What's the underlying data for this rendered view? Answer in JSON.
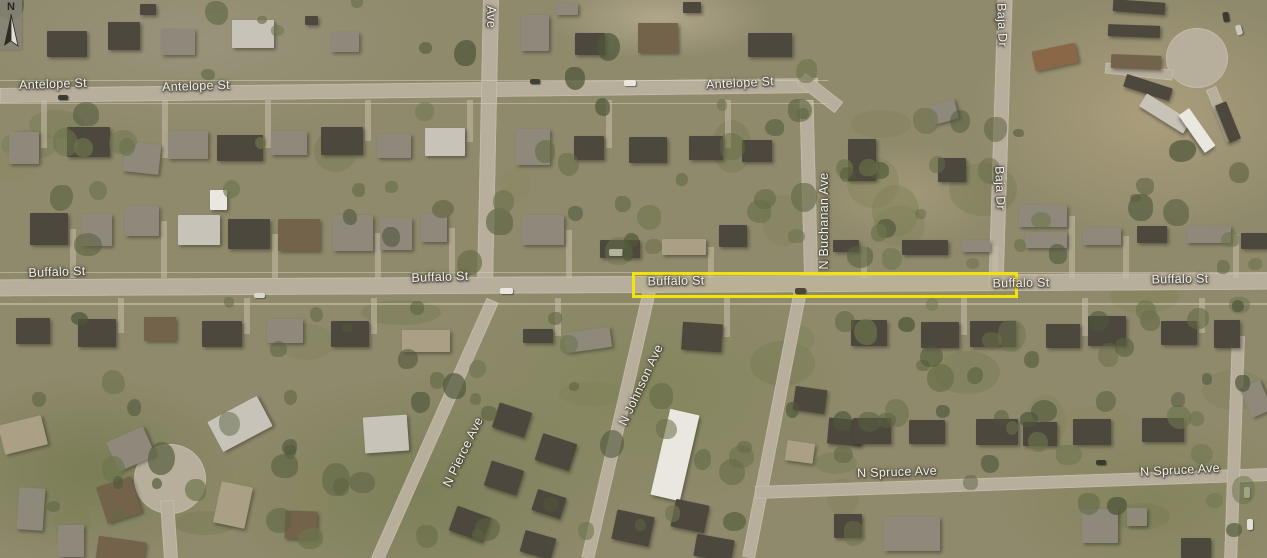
{
  "map": {
    "description": "Aerial imagery of residential neighborhood with highlighted segment of Buffalo St",
    "colors": {
      "highlight": "#f2e40a",
      "label_text": "#f3f1ea",
      "label_shadow": "#45423 8",
      "road": "#b7ae9c",
      "ground": "#8f8a6c"
    },
    "compass": {
      "label": "N"
    },
    "highlight": {
      "x": 633,
      "y": 273,
      "width": 382,
      "height": 22,
      "stroke": 3
    },
    "labels": [
      {
        "text": "Antelope St",
        "x": 53,
        "y": 84,
        "rot": -2
      },
      {
        "text": "Antelope St",
        "x": 196,
        "y": 86,
        "rot": -2
      },
      {
        "text": "Antelope St",
        "x": 740,
        "y": 83,
        "rot": -3
      },
      {
        "text": "Ave",
        "x": 491,
        "y": 17,
        "rot": 90
      },
      {
        "text": "Baja Dr",
        "x": 1002,
        "y": 25,
        "rot": 88
      },
      {
        "text": "Baja Dr",
        "x": 1000,
        "y": 188,
        "rot": 88
      },
      {
        "text": "N Buchanan Ave",
        "x": 824,
        "y": 221,
        "rot": -90
      },
      {
        "text": "Buffalo St",
        "x": 57,
        "y": 272,
        "rot": -2
      },
      {
        "text": "Buffalo St",
        "x": 440,
        "y": 277,
        "rot": -2
      },
      {
        "text": "Buffalo St",
        "x": 676,
        "y": 281,
        "rot": -1
      },
      {
        "text": "Buffalo St",
        "x": 1021,
        "y": 283,
        "rot": -1
      },
      {
        "text": "Buffalo St",
        "x": 1180,
        "y": 279,
        "rot": -1
      },
      {
        "text": "N Johnson Ave",
        "x": 641,
        "y": 385,
        "rot": -65
      },
      {
        "text": "N Pierce Ave",
        "x": 463,
        "y": 452,
        "rot": -64
      },
      {
        "text": "N Spruce Ave",
        "x": 897,
        "y": 472,
        "rot": -2
      },
      {
        "text": "N Spruce Ave",
        "x": 1180,
        "y": 470,
        "rot": -3
      }
    ],
    "roads": [
      {
        "name": "antelope-st",
        "x": 0,
        "y": 83,
        "w": 818,
        "h": 15,
        "rot": -0.7
      },
      {
        "name": "antelope-buchanan-curve",
        "x": 796,
        "y": 86,
        "w": 48,
        "h": 14,
        "rot": 38
      },
      {
        "name": "ave-road",
        "x": 480,
        "y": -4,
        "w": 16,
        "h": 292,
        "rot": 1.2
      },
      {
        "name": "n-buchanan-ave-north",
        "x": 802,
        "y": 100,
        "w": 14,
        "h": 192,
        "rot": -1.5
      },
      {
        "name": "buffalo-st",
        "x": -4,
        "y": 276,
        "w": 1275,
        "h": 17,
        "rot": -0.3
      },
      {
        "name": "baja-dr",
        "x": 993,
        "y": -4,
        "w": 15,
        "h": 292,
        "rot": 1.8
      },
      {
        "name": "n-buchanan-ave-south",
        "x": 768,
        "y": 288,
        "w": 13,
        "h": 272,
        "rot": 11
      },
      {
        "name": "n-johnson-ave",
        "x": 612,
        "y": 288,
        "w": 13,
        "h": 274,
        "rot": 13
      },
      {
        "name": "n-pierce-ave",
        "x": 428,
        "y": 288,
        "w": 13,
        "h": 286,
        "rot": 24
      },
      {
        "name": "n-spruce-ave",
        "x": 755,
        "y": 477,
        "w": 516,
        "h": 13,
        "rot": -2
      },
      {
        "name": "east-edge-road",
        "x": 1228,
        "y": 336,
        "w": 13,
        "h": 226,
        "rot": 2
      },
      {
        "name": "cul-de-sac-west",
        "shape": "circle",
        "x": 134,
        "y": 444,
        "w": 72,
        "h": 70
      },
      {
        "name": "cul-de-sac-stem",
        "x": 162,
        "y": 500,
        "w": 14,
        "h": 60,
        "rot": -4
      },
      {
        "name": "trailer-court-circle",
        "shape": "circle",
        "x": 1166,
        "y": 28,
        "w": 62,
        "h": 60
      },
      {
        "name": "trailer-court-drive-west",
        "x": 1105,
        "y": 66,
        "w": 68,
        "h": 11,
        "rot": 6
      },
      {
        "name": "trailer-court-drive-south",
        "x": 1216,
        "y": 86,
        "w": 11,
        "h": 56,
        "rot": -22
      }
    ],
    "buildings": [
      [
        67,
        44,
        40,
        26,
        "d",
        0
      ],
      [
        124,
        36,
        32,
        28,
        "d",
        0
      ],
      [
        178,
        42,
        34,
        26,
        "g",
        0
      ],
      [
        253,
        34,
        42,
        28,
        "l",
        0
      ],
      [
        148,
        9,
        16,
        11,
        "d",
        0
      ],
      [
        345,
        42,
        28,
        20,
        "g",
        0
      ],
      [
        311,
        20,
        13,
        9,
        "d",
        0
      ],
      [
        535,
        33,
        28,
        36,
        "g",
        0
      ],
      [
        590,
        44,
        30,
        22,
        "d",
        0
      ],
      [
        658,
        38,
        40,
        30,
        "b",
        0
      ],
      [
        692,
        7,
        18,
        11,
        "d",
        0
      ],
      [
        770,
        45,
        44,
        24,
        "d",
        0
      ],
      [
        567,
        9,
        22,
        12,
        "g",
        0
      ],
      [
        1139,
        7,
        52,
        12,
        "d",
        4
      ],
      [
        1134,
        31,
        52,
        12,
        "d",
        2
      ],
      [
        1136,
        62,
        50,
        14,
        "b",
        2
      ],
      [
        1148,
        87,
        48,
        13,
        "d",
        18
      ],
      [
        1165,
        113,
        52,
        15,
        "l",
        32
      ],
      [
        1197,
        130,
        46,
        13,
        "w",
        55
      ],
      [
        1228,
        122,
        40,
        12,
        "d",
        68
      ],
      [
        1055,
        57,
        44,
        20,
        "o",
        -12
      ],
      [
        862,
        160,
        28,
        42,
        "d",
        0
      ],
      [
        944,
        112,
        26,
        20,
        "g",
        -15
      ],
      [
        952,
        170,
        28,
        24,
        "d",
        0
      ],
      [
        1043,
        216,
        48,
        22,
        "g",
        0
      ],
      [
        1046,
        240,
        42,
        16,
        "g",
        0
      ],
      [
        1102,
        236,
        38,
        17,
        "g",
        0
      ],
      [
        1152,
        234,
        30,
        17,
        "d",
        0
      ],
      [
        1209,
        234,
        44,
        17,
        "g",
        0
      ],
      [
        1254,
        241,
        26,
        16,
        "d",
        0
      ],
      [
        24,
        148,
        30,
        32,
        "g",
        0
      ],
      [
        88,
        142,
        43,
        30,
        "d",
        0
      ],
      [
        142,
        158,
        36,
        30,
        "g",
        6
      ],
      [
        188,
        145,
        40,
        28,
        "g",
        0
      ],
      [
        240,
        148,
        46,
        26,
        "d",
        0
      ],
      [
        289,
        143,
        36,
        24,
        "g",
        0
      ],
      [
        342,
        141,
        42,
        28,
        "d",
        0
      ],
      [
        394,
        146,
        34,
        24,
        "g",
        0
      ],
      [
        445,
        142,
        40,
        28,
        "l",
        0
      ],
      [
        533,
        147,
        34,
        36,
        "g",
        0
      ],
      [
        589,
        148,
        30,
        24,
        "d",
        0
      ],
      [
        648,
        150,
        38,
        26,
        "d",
        0
      ],
      [
        706,
        148,
        34,
        24,
        "d",
        0
      ],
      [
        757,
        151,
        30,
        22,
        "d",
        0
      ],
      [
        49,
        229,
        38,
        32,
        "d",
        0
      ],
      [
        97,
        230,
        30,
        32,
        "g",
        0
      ],
      [
        142,
        221,
        34,
        30,
        "g",
        0
      ],
      [
        199,
        230,
        42,
        30,
        "l",
        0
      ],
      [
        249,
        234,
        42,
        30,
        "d",
        0
      ],
      [
        299,
        235,
        42,
        32,
        "b",
        0
      ],
      [
        353,
        233,
        40,
        36,
        "g",
        0
      ],
      [
        396,
        234,
        32,
        32,
        "g",
        0
      ],
      [
        434,
        228,
        26,
        28,
        "g",
        0
      ],
      [
        218,
        200,
        17,
        20,
        "w",
        0
      ],
      [
        543,
        230,
        42,
        30,
        "g",
        0
      ],
      [
        620,
        249,
        40,
        18,
        "d",
        0
      ],
      [
        684,
        247,
        44,
        16,
        "t",
        0
      ],
      [
        733,
        236,
        28,
        22,
        "d",
        0
      ],
      [
        846,
        246,
        26,
        12,
        "d",
        0
      ],
      [
        925,
        247,
        46,
        15,
        "d",
        0
      ],
      [
        976,
        246,
        28,
        12,
        "g",
        0
      ],
      [
        33,
        331,
        34,
        26,
        "d",
        0
      ],
      [
        97,
        333,
        38,
        28,
        "d",
        0
      ],
      [
        160,
        329,
        32,
        24,
        "b",
        0
      ],
      [
        222,
        334,
        40,
        26,
        "d",
        0
      ],
      [
        285,
        331,
        36,
        24,
        "g",
        0
      ],
      [
        350,
        334,
        38,
        26,
        "d",
        0
      ],
      [
        426,
        341,
        48,
        22,
        "t",
        0
      ],
      [
        538,
        336,
        30,
        14,
        "d",
        0
      ],
      [
        588,
        340,
        46,
        20,
        "g",
        -8
      ],
      [
        702,
        337,
        40,
        28,
        "d",
        4
      ],
      [
        869,
        333,
        36,
        26,
        "d",
        0
      ],
      [
        940,
        335,
        38,
        26,
        "d",
        0
      ],
      [
        993,
        334,
        46,
        26,
        "d",
        0
      ],
      [
        1063,
        336,
        34,
        24,
        "d",
        0
      ],
      [
        1107,
        331,
        38,
        30,
        "d",
        0
      ],
      [
        1179,
        333,
        36,
        24,
        "d",
        0
      ],
      [
        1227,
        334,
        26,
        28,
        "d",
        0
      ],
      [
        675,
        455,
        30,
        88,
        "w",
        13
      ],
      [
        512,
        420,
        34,
        26,
        "d",
        18
      ],
      [
        556,
        452,
        36,
        28,
        "d",
        18
      ],
      [
        504,
        478,
        34,
        26,
        "d",
        18
      ],
      [
        549,
        504,
        30,
        22,
        "d",
        18
      ],
      [
        538,
        545,
        32,
        22,
        "d",
        16
      ],
      [
        470,
        524,
        36,
        26,
        "d",
        20
      ],
      [
        633,
        528,
        38,
        30,
        "d",
        12
      ],
      [
        690,
        516,
        34,
        28,
        "d",
        12
      ],
      [
        714,
        548,
        38,
        22,
        "d",
        10
      ],
      [
        810,
        400,
        32,
        24,
        "d",
        8
      ],
      [
        845,
        432,
        34,
        26,
        "d",
        5
      ],
      [
        800,
        452,
        28,
        20,
        "t",
        8
      ],
      [
        23,
        435,
        44,
        30,
        "t",
        -14
      ],
      [
        131,
        449,
        40,
        32,
        "g",
        -24
      ],
      [
        240,
        424,
        56,
        34,
        "l",
        -28
      ],
      [
        386,
        434,
        44,
        36,
        "l",
        -4
      ],
      [
        31,
        509,
        26,
        42,
        "g",
        4
      ],
      [
        71,
        541,
        26,
        32,
        "g",
        0
      ],
      [
        121,
        551,
        48,
        24,
        "b",
        8
      ],
      [
        119,
        500,
        36,
        38,
        "b",
        -18
      ],
      [
        233,
        505,
        32,
        42,
        "t",
        12
      ],
      [
        301,
        525,
        32,
        28,
        "b",
        2
      ],
      [
        912,
        534,
        56,
        34,
        "g",
        0
      ],
      [
        1100,
        526,
        36,
        34,
        "g",
        0
      ],
      [
        1137,
        517,
        20,
        18,
        "g",
        0
      ],
      [
        1196,
        548,
        30,
        20,
        "d",
        0
      ],
      [
        848,
        526,
        28,
        24,
        "d",
        0
      ],
      [
        872,
        431,
        38,
        26,
        "d",
        0
      ],
      [
        927,
        432,
        36,
        24,
        "d",
        0
      ],
      [
        997,
        432,
        42,
        26,
        "d",
        0
      ],
      [
        1040,
        434,
        34,
        24,
        "d",
        0
      ],
      [
        1092,
        432,
        38,
        26,
        "d",
        0
      ],
      [
        1163,
        430,
        42,
        24,
        "d",
        0
      ],
      [
        1256,
        399,
        22,
        32,
        "g",
        -24
      ]
    ],
    "vehicles": [
      [
        506,
        291,
        13,
        6,
        "#e9e7df",
        0
      ],
      [
        616,
        252,
        14,
        7,
        "#f0eee6",
        0
      ],
      [
        800,
        291,
        11,
        6,
        "#45423a",
        0
      ],
      [
        63,
        97,
        10,
        5,
        "#3c3a33",
        0
      ],
      [
        535,
        81,
        10,
        5,
        "#413e37",
        0
      ],
      [
        630,
        83,
        12,
        6,
        "#e8e6de",
        0
      ],
      [
        1101,
        462,
        10,
        5,
        "#3a382f",
        0
      ],
      [
        1247,
        492,
        6,
        11,
        "#dcdad1",
        0
      ],
      [
        1250,
        524,
        6,
        11,
        "#e2e0d8",
        0
      ],
      [
        1226,
        17,
        6,
        10,
        "#3b3932",
        -10
      ],
      [
        1239,
        30,
        6,
        10,
        "#c9c7be",
        -15
      ],
      [
        259,
        295,
        11,
        5,
        "#d8d6cd",
        0
      ]
    ]
  }
}
